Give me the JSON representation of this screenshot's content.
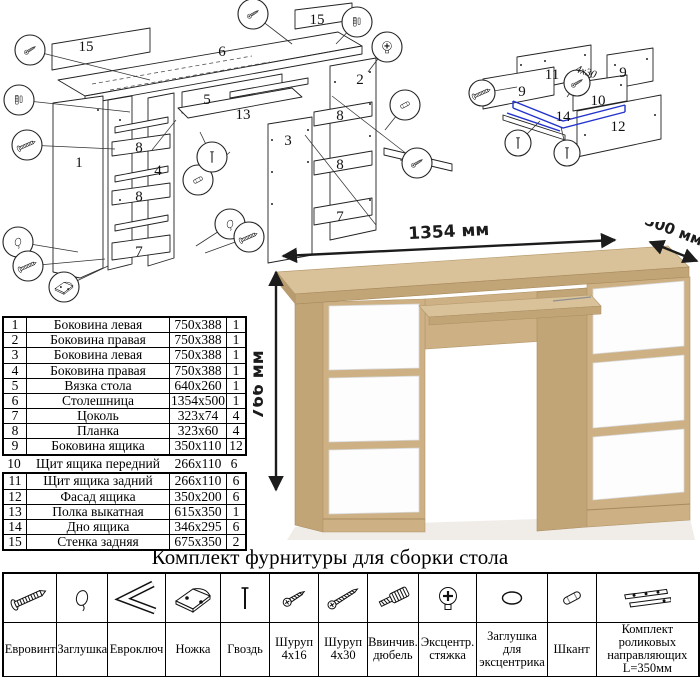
{
  "dimensions": {
    "width_label": "1354 мм",
    "depth_label": "500 мм",
    "height_label": "766 мм"
  },
  "diagram_main": {
    "name": "exploded-desk-assembly",
    "labels": [
      {
        "t": "15",
        "x": 86,
        "y": 51
      },
      {
        "t": "6",
        "x": 222,
        "y": 56
      },
      {
        "t": "15",
        "x": 317,
        "y": 24
      },
      {
        "t": "5",
        "x": 207,
        "y": 104
      },
      {
        "t": "13",
        "x": 243,
        "y": 119
      },
      {
        "t": "2",
        "x": 360,
        "y": 84
      },
      {
        "t": "3",
        "x": 288,
        "y": 145
      },
      {
        "t": "1",
        "x": 79,
        "y": 167
      },
      {
        "t": "4",
        "x": 158,
        "y": 175
      },
      {
        "t": "8",
        "x": 139,
        "y": 152
      },
      {
        "t": "8",
        "x": 139,
        "y": 201
      },
      {
        "t": "8",
        "x": 340,
        "y": 120
      },
      {
        "t": "8",
        "x": 340,
        "y": 169
      },
      {
        "t": "7",
        "x": 139,
        "y": 256
      },
      {
        "t": "7",
        "x": 340,
        "y": 221
      }
    ],
    "callouts": [
      {
        "x": 30,
        "y": 50,
        "icon": "screw-small",
        "tx": 150,
        "ty": 80
      },
      {
        "x": 19,
        "y": 100,
        "icon": "dowel-pair",
        "tx": 130,
        "ty": 112
      },
      {
        "x": 27,
        "y": 145,
        "icon": "euroscrew",
        "tx": 115,
        "ty": 149
      },
      {
        "x": 18,
        "y": 242,
        "icon": "cap",
        "tx": 78,
        "ty": 252
      },
      {
        "x": 28,
        "y": 266,
        "icon": "euroscrew",
        "tx": 105,
        "ty": 259
      },
      {
        "x": 64,
        "y": 287,
        "icon": "foot",
        "tx": 108,
        "ty": 266
      },
      {
        "x": 253,
        "y": 14,
        "icon": "screw-small",
        "tx": 292,
        "ty": 44
      },
      {
        "x": 357,
        "y": 22,
        "icon": "dowel-pair",
        "tx": 336,
        "ty": 44
      },
      {
        "x": 387,
        "y": 47,
        "icon": "cam-lock",
        "tx": 368,
        "ty": 72
      },
      {
        "x": 198,
        "y": 180,
        "icon": "wood-dowel",
        "tx": 230,
        "ty": 152
      },
      {
        "x": 212,
        "y": 157,
        "icon": "nail",
        "tx": 200,
        "ty": 132
      },
      {
        "x": 405,
        "y": 105,
        "icon": "wood-dowel",
        "tx": 385,
        "ty": 130
      },
      {
        "x": 417,
        "y": 163,
        "icon": "screw-small",
        "tx": 400,
        "ty": 160
      },
      {
        "x": 230,
        "y": 224,
        "icon": "cap",
        "tx": 196,
        "ty": 246
      },
      {
        "x": 249,
        "y": 237,
        "icon": "euroscrew",
        "tx": 205,
        "ty": 253
      }
    ]
  },
  "diagram_drawer": {
    "name": "exploded-drawer-assembly",
    "labels": [
      {
        "t": "11",
        "x": 97,
        "y": 44
      },
      {
        "t": "9",
        "x": 67,
        "y": 61
      },
      {
        "t": "9",
        "x": 168,
        "y": 42
      },
      {
        "t": "10",
        "x": 143,
        "y": 70
      },
      {
        "t": "14",
        "x": 108,
        "y": 86
      },
      {
        "t": "12",
        "x": 163,
        "y": 96
      }
    ],
    "screw_note": "4x30",
    "callouts": [
      {
        "x": 27,
        "y": 58,
        "icon": "euroscrew",
        "tx": 62,
        "ty": 52
      },
      {
        "x": 122,
        "y": 48,
        "icon": "screw-small",
        "tx": 112,
        "ty": 62
      },
      {
        "x": 63,
        "y": 108,
        "icon": "nail",
        "tx": 85,
        "ty": 86
      },
      {
        "x": 112,
        "y": 118,
        "icon": "nail",
        "tx": 106,
        "ty": 92
      }
    ]
  },
  "parts_table": {
    "rows": [
      [
        "1",
        "Боковина левая",
        "750x388",
        "1"
      ],
      [
        "2",
        "Боковина правая",
        "750x388",
        "1"
      ],
      [
        "3",
        "Боковина левая",
        "750x388",
        "1"
      ],
      [
        "4",
        "Боковина правая",
        "750x388",
        "1"
      ],
      [
        "5",
        "Вязка стола",
        "640x260",
        "1"
      ],
      [
        "6",
        "Столешница",
        "1354x500",
        "1"
      ],
      [
        "7",
        "Цоколь",
        "323x74",
        "4"
      ],
      [
        "8",
        "Планка",
        "323x60",
        "4"
      ],
      [
        "9",
        "Боковина ящика",
        "350x110",
        "12"
      ],
      [
        "10",
        "Щит ящика передний",
        "266x110",
        "6"
      ],
      [
        "11",
        "Щит ящика задний",
        "266x110",
        "6"
      ],
      [
        "12",
        "Фасад ящика",
        "350x200",
        "6"
      ],
      [
        "13",
        "Полка выкатная",
        "615x350",
        "1"
      ],
      [
        "14",
        "Дно ящика",
        "346x295",
        "6"
      ],
      [
        "15",
        "Стенка задняя",
        "675x350",
        "2"
      ]
    ]
  },
  "hardware": {
    "title": "Комплект фурнитуры для сборки стола",
    "items": [
      {
        "name": "Евровинт",
        "qty": "36",
        "icon": "euroscrew"
      },
      {
        "name": "Заглушка",
        "qty": "8",
        "icon": "cap"
      },
      {
        "name": "Евроключ",
        "qty": "1",
        "icon": "hexkey"
      },
      {
        "name": "Ножка",
        "qty": "8",
        "icon": "foot"
      },
      {
        "name": "Гвоздь",
        "qty": "50",
        "icon": "nail"
      },
      {
        "name": "Шуруп 4x16",
        "qty": "56",
        "icon": "screw-small"
      },
      {
        "name": "Шуруп 4x30",
        "qty": "12",
        "icon": "screw-large"
      },
      {
        "name": "Ввинчив. дюбель",
        "qty": "8",
        "icon": "dowel-screw"
      },
      {
        "name": "Эксцентр. стяжка",
        "qty": "8",
        "icon": "cam-lock"
      },
      {
        "name": "Заглушка для эксцентрика",
        "qty": "8",
        "icon": "cam-cap"
      },
      {
        "name": "Шкант",
        "qty": "24",
        "icon": "wood-dowel"
      },
      {
        "name": "Комплект роликовых направляющих L=350мм",
        "qty": "7",
        "icon": "drawer-slides"
      }
    ]
  },
  "colors": {
    "oak_top": "#d9c29a",
    "oak_front": "#cdb185",
    "oak_side": "#c2a577",
    "oak_edge": "#a8895c",
    "drawer_white": "#fdfdfd",
    "line": "#1a1a1a",
    "highlight_blue": "#2233cc"
  }
}
